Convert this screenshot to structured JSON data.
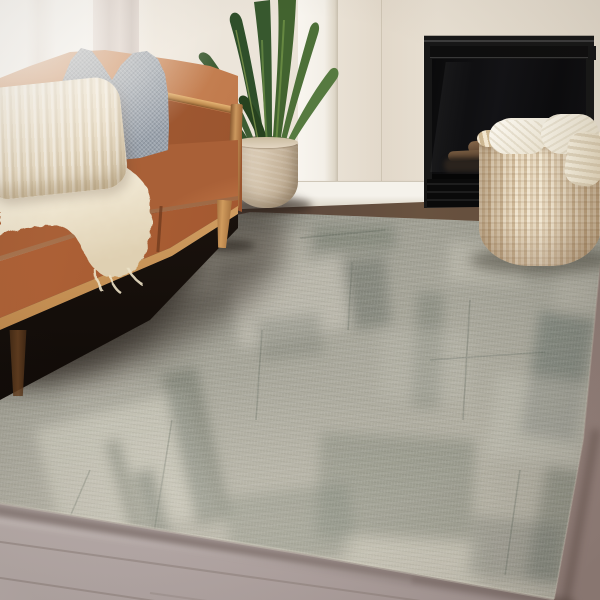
{
  "scene": {
    "type": "interior photograph",
    "setting": "living room corner, daytime window light from the left",
    "no_visible_text": true
  },
  "objects": {
    "sofa": {
      "style": "mid-century leather sofa",
      "leather_color": "#b06a3e",
      "wood_frame_color": "#c08c50",
      "legs": "tapered oak"
    },
    "gray_pillow": {
      "texture": "chunky knit",
      "color": "#98a0aa"
    },
    "cream_pillow": {
      "texture": "ribbed lumbar",
      "color": "#e9dfc9"
    },
    "throw_blanket": {
      "texture": "fuzzy sherpa",
      "color": "#f2ebd9"
    },
    "curtain": {
      "color": "#d5c8c2"
    },
    "plant": {
      "type": "tall strap-leaf houseplant",
      "leaf_colors": [
        "#2f4f2a",
        "#42632f",
        "#567a40"
      ],
      "pot_color": "#d4c4ad"
    },
    "fireplace": {
      "finish": "matte black insert",
      "color": "#171717",
      "contents": "stacked firewood logs",
      "log_color": "#7b5f43"
    },
    "basket": {
      "material": "woven jute",
      "color": "#d9c6a5",
      "contents": "folded cream knit blankets"
    },
    "rug": {
      "style": "abstract distressed patchwork area rug",
      "base_color": "#a6a59a",
      "light_patch_color": "#d2cfc1",
      "dark_streak_color": "#5f665b"
    },
    "floor": {
      "upper_color": "#55423a",
      "lower_left_color": "#b6aaa8",
      "lower_right_color": "#86746e"
    },
    "wall": {
      "color": "#ece5da",
      "trim_color": "#f3efe7",
      "baseboard_color": "#f5f2eb"
    }
  }
}
